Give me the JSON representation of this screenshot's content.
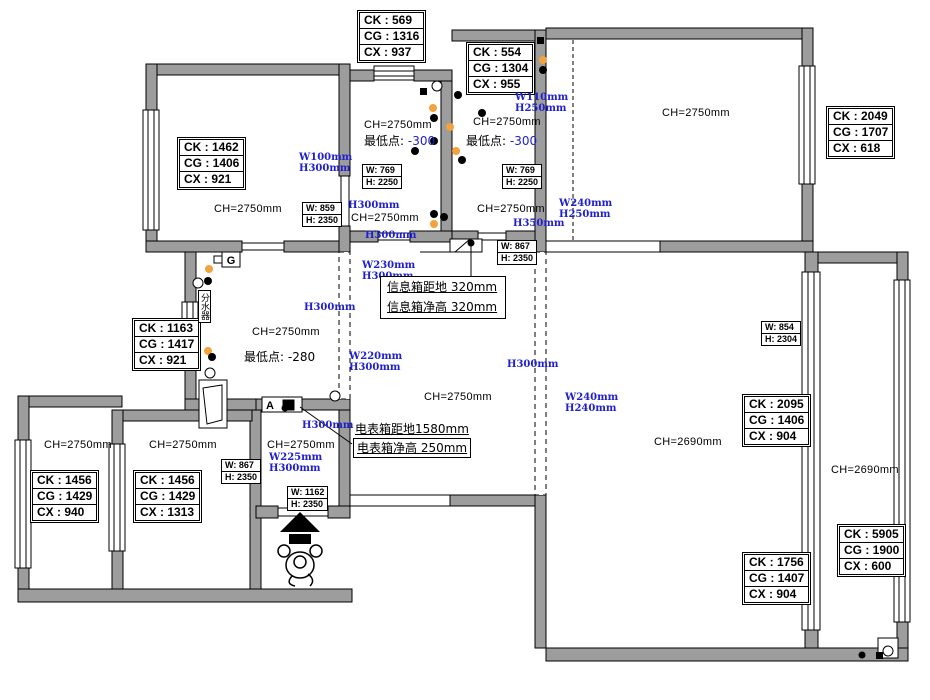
{
  "ck_boxes": [
    {
      "lines": [
        "CK : 569",
        "CG : 1316",
        "CX : 937"
      ]
    },
    {
      "lines": [
        "CK : 554",
        "CG : 1304",
        "CX : 955"
      ]
    },
    {
      "lines": [
        "CK : 2049",
        "CG : 1707",
        "CX : 618"
      ]
    },
    {
      "lines": [
        "CK : 1462",
        "CG : 1406",
        "CX : 921"
      ]
    },
    {
      "lines": [
        "CK : 1163",
        "CG : 1417",
        "CX : 921"
      ]
    },
    {
      "lines": [
        "CK : 1456",
        "CG : 1429",
        "CX : 940"
      ]
    },
    {
      "lines": [
        "CK : 1456",
        "CG : 1429",
        "CX : 1313"
      ]
    },
    {
      "lines": [
        "CK : 2095",
        "CG : 1406",
        "CX : 904"
      ]
    },
    {
      "lines": [
        "CK : 1756",
        "CG : 1407",
        "CX : 904"
      ]
    },
    {
      "lines": [
        "CK : 5905",
        "CG : 1900",
        "CX : 600"
      ]
    }
  ],
  "wh_boxes": [
    {
      "w": "W: 769",
      "h": "H: 2250"
    },
    {
      "w": "W: 769",
      "h": "H: 2250"
    },
    {
      "w": "W: 859",
      "h": "H: 2350"
    },
    {
      "w": "W: 867",
      "h": "H: 2350"
    },
    {
      "w": "W: 854",
      "h": "H: 2304"
    },
    {
      "w": "W: 867",
      "h": "H: 2350"
    },
    {
      "w": "W: 1162",
      "h": "H: 2350"
    }
  ],
  "ch_labels": [
    "CH=2750mm",
    "CH=2750mm",
    "CH=2750mm",
    "CH=2750mm",
    "CH=2750mm",
    "CH=2750mm",
    "CH=2750mm",
    "CH=2750mm",
    "CH=2750mm",
    "CH=2750mm",
    "CH=2750mm",
    "CH=2690mm",
    "CH=2690mm"
  ],
  "blue_dims": [
    [
      "W100mm",
      "H300mm"
    ],
    [
      "W110mm",
      "H250mm"
    ],
    [
      "H300mm"
    ],
    [
      "H300mm"
    ],
    [
      "H350mm"
    ],
    [
      "W240mm",
      "H250mm"
    ],
    [
      "W230mm",
      "H300mm"
    ],
    [
      "H300mm"
    ],
    [
      "W220mm",
      "H300mm"
    ],
    [
      "H300mm"
    ],
    [
      "W240mm",
      "H240mm"
    ],
    [
      "H300mm"
    ],
    [
      "W225mm",
      "H300mm"
    ]
  ],
  "notes": {
    "min_point_a_label": "最低点:",
    "min_point_a_value": "-300",
    "min_point_b_label": "最低点:",
    "min_point_b_value": "-300",
    "min_point_c_label": "最低点:",
    "min_point_c_value": "-280",
    "info_box_offset": "信息箱距地 320mm",
    "info_box_clear": "信息箱净高 320mm",
    "meter_box_offset": "电表箱距地1580mm",
    "meter_box_clear": "电表箱净高 250mm",
    "water_manifold": "分水器",
    "gas_meter": "G",
    "panel": "A"
  },
  "colors": {
    "wall": "#9d9d9d",
    "dim_blue": "#2020cc",
    "marker_orange": "#f2a33c"
  }
}
